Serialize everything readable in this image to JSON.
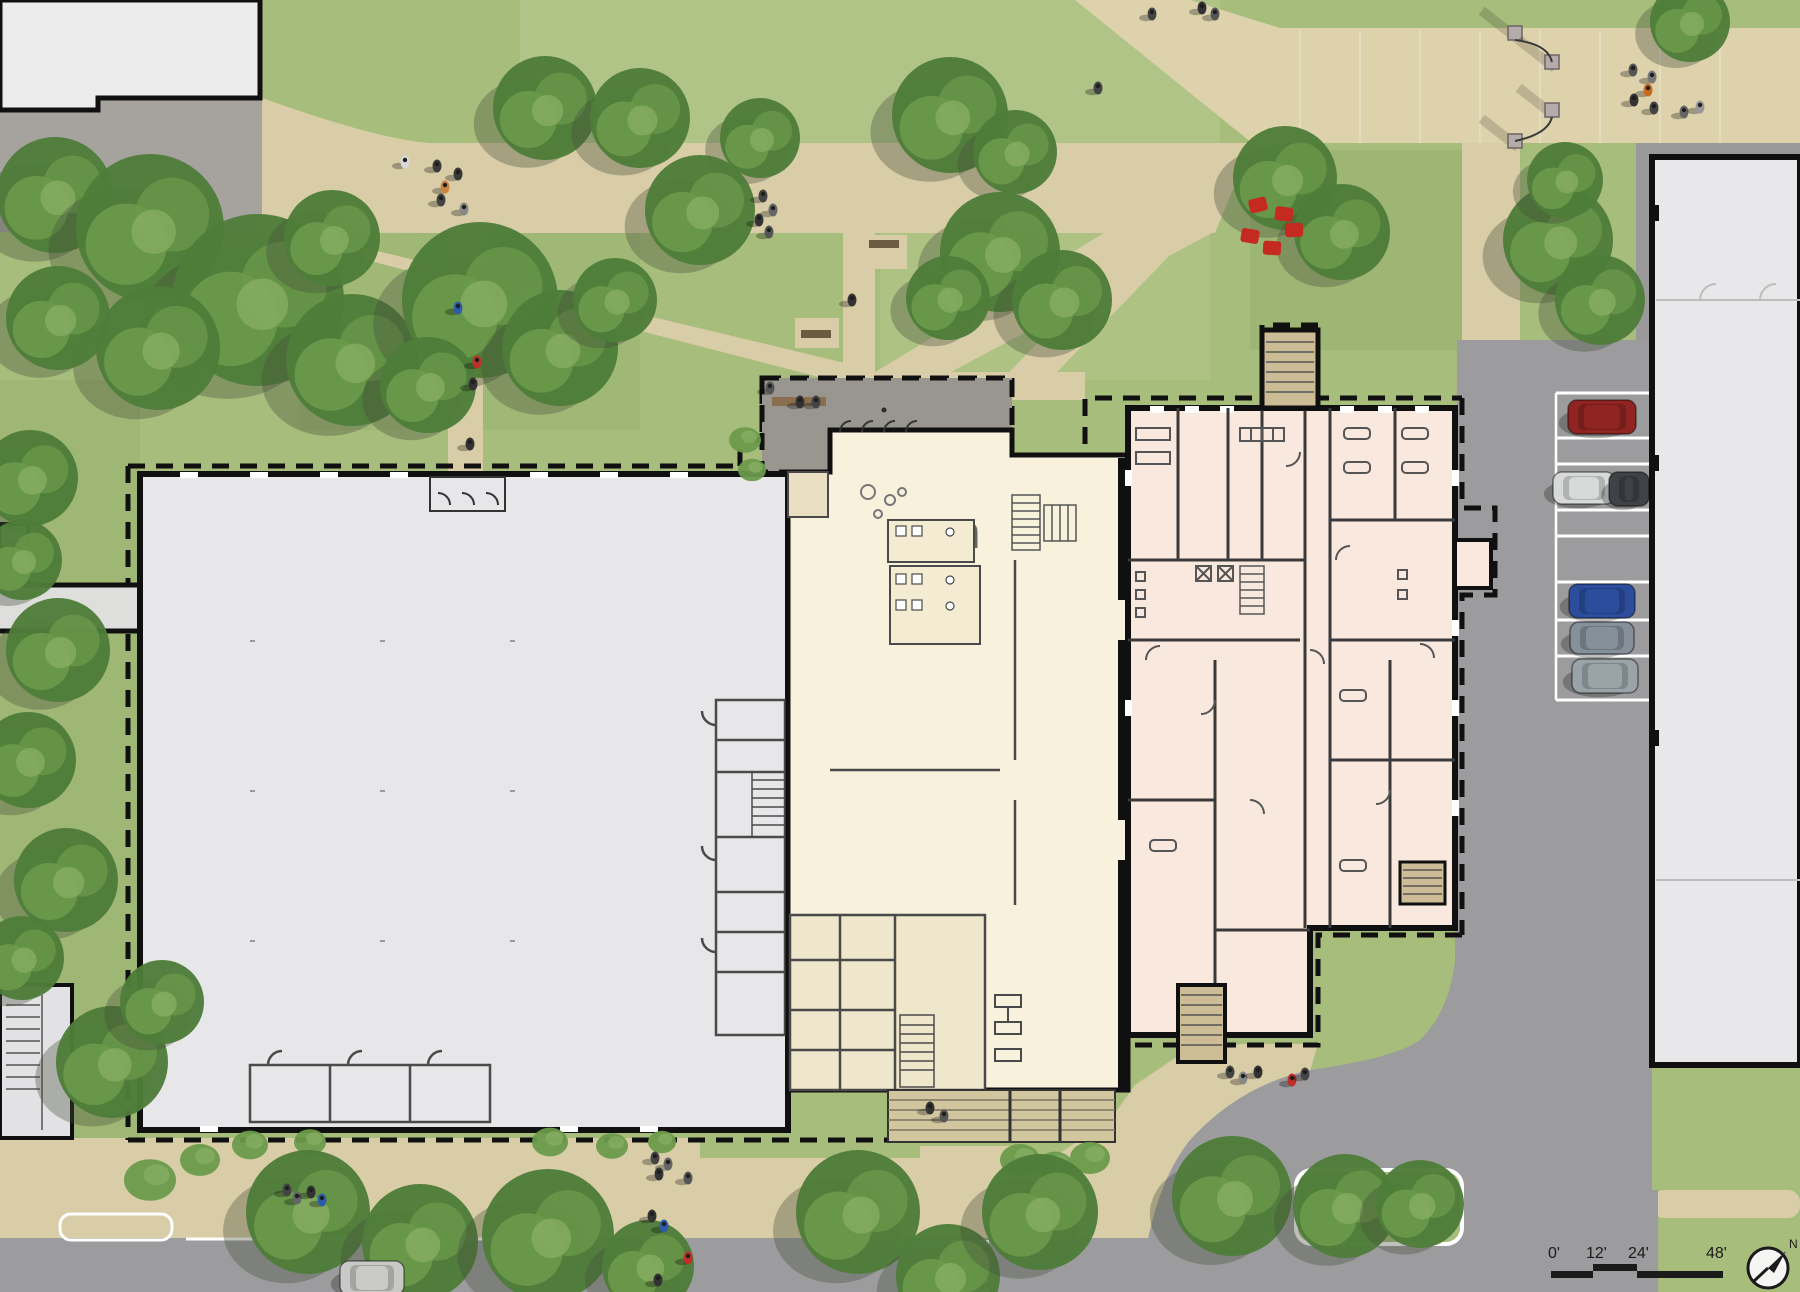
{
  "drawing": {
    "kind": "architectural-site-plan",
    "scalebar": {
      "labels": [
        "0'",
        "12'",
        "24'",
        "48'"
      ],
      "label_pos": [
        [
          1548,
          1258
        ],
        [
          1586,
          1258
        ],
        [
          1628,
          1258
        ],
        [
          1706,
          1258
        ]
      ],
      "segments": [
        {
          "x": 1551,
          "w": 42,
          "dy": 0
        },
        {
          "x": 1593,
          "w": 44,
          "dy": -7
        },
        {
          "x": 1637,
          "w": 86,
          "dy": 0
        }
      ],
      "bar_y": 1271,
      "bar_h": 7
    },
    "north_label": "N"
  },
  "colors": {
    "grass": "#a7bd7c",
    "grass_light": "#b9cb92",
    "grass_dark": "#93ad68",
    "tree_dark": "#4e7d39",
    "tree_mid": "#6b9a4b",
    "tree_light": "#87ae63",
    "shadow": "rgba(70,78,58,0.35)",
    "path": "#d9cda7",
    "path_light": "#e0d6b2",
    "road": "#9c9c9e",
    "road_line": "#ffffff",
    "plaza": "#a6a39e",
    "terrace": "#98968f",
    "bldg_gray": "#e7e7e9",
    "bldg_cream": "#f8f1dc",
    "bldg_cream_dark": "#eadfc2",
    "bldg_pink": "#f9e8de",
    "bldg_pink_dark": "#f3dccd",
    "wall": "#101010",
    "wall_thin": "#4a4a4a",
    "bench": "#8a6f4e",
    "bollard": "#b5abab",
    "blanket": "#c42a20"
  },
  "trees": [
    {
      "x": 55,
      "y": 195,
      "r": 58
    },
    {
      "x": 150,
      "y": 228,
      "r": 74
    },
    {
      "x": 258,
      "y": 300,
      "r": 86
    },
    {
      "x": 352,
      "y": 360,
      "r": 66
    },
    {
      "x": 158,
      "y": 348,
      "r": 62
    },
    {
      "x": 58,
      "y": 318,
      "r": 52
    },
    {
      "x": 332,
      "y": 238,
      "r": 48
    },
    {
      "x": 545,
      "y": 108,
      "r": 52
    },
    {
      "x": 640,
      "y": 118,
      "r": 50
    },
    {
      "x": 760,
      "y": 138,
      "r": 40
    },
    {
      "x": 950,
      "y": 115,
      "r": 58
    },
    {
      "x": 1015,
      "y": 152,
      "r": 42
    },
    {
      "x": 480,
      "y": 300,
      "r": 78
    },
    {
      "x": 560,
      "y": 348,
      "r": 58
    },
    {
      "x": 428,
      "y": 385,
      "r": 48
    },
    {
      "x": 615,
      "y": 300,
      "r": 42
    },
    {
      "x": 700,
      "y": 210,
      "r": 55
    },
    {
      "x": 1000,
      "y": 252,
      "r": 60
    },
    {
      "x": 1062,
      "y": 300,
      "r": 50
    },
    {
      "x": 948,
      "y": 298,
      "r": 42
    },
    {
      "x": 1285,
      "y": 178,
      "r": 52
    },
    {
      "x": 1342,
      "y": 232,
      "r": 48
    },
    {
      "x": 1558,
      "y": 240,
      "r": 55
    },
    {
      "x": 1600,
      "y": 300,
      "r": 45
    },
    {
      "x": 1565,
      "y": 180,
      "r": 38
    },
    {
      "x": 1690,
      "y": 22,
      "r": 40
    },
    {
      "x": 30,
      "y": 478,
      "r": 48
    },
    {
      "x": 22,
      "y": 560,
      "r": 40
    },
    {
      "x": 58,
      "y": 650,
      "r": 52
    },
    {
      "x": 28,
      "y": 760,
      "r": 48
    },
    {
      "x": 66,
      "y": 880,
      "r": 52
    },
    {
      "x": 22,
      "y": 958,
      "r": 42
    },
    {
      "x": 112,
      "y": 1062,
      "r": 56
    },
    {
      "x": 162,
      "y": 1002,
      "r": 42
    },
    {
      "x": 308,
      "y": 1212,
      "r": 62
    },
    {
      "x": 420,
      "y": 1242,
      "r": 58
    },
    {
      "x": 548,
      "y": 1235,
      "r": 66
    },
    {
      "x": 648,
      "y": 1266,
      "r": 46
    },
    {
      "x": 858,
      "y": 1212,
      "r": 62
    },
    {
      "x": 948,
      "y": 1276,
      "r": 52
    },
    {
      "x": 1040,
      "y": 1212,
      "r": 58
    },
    {
      "x": 1232,
      "y": 1196,
      "r": 60
    },
    {
      "x": 1345,
      "y": 1206,
      "r": 52
    },
    {
      "x": 1420,
      "y": 1204,
      "r": 44
    }
  ],
  "bushes": [
    {
      "x": 1020,
      "y": 1160,
      "r": 20
    },
    {
      "x": 1055,
      "y": 1166,
      "r": 18
    },
    {
      "x": 1090,
      "y": 1158,
      "r": 20
    },
    {
      "x": 250,
      "y": 1145,
      "r": 18
    },
    {
      "x": 310,
      "y": 1142,
      "r": 16
    },
    {
      "x": 550,
      "y": 1142,
      "r": 18
    },
    {
      "x": 612,
      "y": 1146,
      "r": 16
    },
    {
      "x": 662,
      "y": 1142,
      "r": 14
    },
    {
      "x": 150,
      "y": 1180,
      "r": 26
    },
    {
      "x": 200,
      "y": 1160,
      "r": 20
    },
    {
      "x": 745,
      "y": 440,
      "r": 16
    },
    {
      "x": 752,
      "y": 470,
      "r": 14
    }
  ],
  "people": [
    {
      "x": 405,
      "y": 162,
      "c": "#d8d8d8"
    },
    {
      "x": 437,
      "y": 166,
      "c": "#3a3a3a"
    },
    {
      "x": 458,
      "y": 174,
      "c": "#3a3a3a"
    },
    {
      "x": 445,
      "y": 187,
      "c": "#c9823f"
    },
    {
      "x": 441,
      "y": 200,
      "c": "#444444"
    },
    {
      "x": 464,
      "y": 209,
      "c": "#888888"
    },
    {
      "x": 458,
      "y": 308,
      "c": "#2a5caa"
    },
    {
      "x": 477,
      "y": 362,
      "c": "#c03028"
    },
    {
      "x": 473,
      "y": 384,
      "c": "#333333"
    },
    {
      "x": 470,
      "y": 444,
      "c": "#333333"
    },
    {
      "x": 763,
      "y": 196,
      "c": "#444444"
    },
    {
      "x": 773,
      "y": 210,
      "c": "#666666"
    },
    {
      "x": 759,
      "y": 220,
      "c": "#333333"
    },
    {
      "x": 769,
      "y": 232,
      "c": "#555555"
    },
    {
      "x": 852,
      "y": 300,
      "c": "#333333"
    },
    {
      "x": 1202,
      "y": 8,
      "c": "#333333"
    },
    {
      "x": 1215,
      "y": 14,
      "c": "#555555"
    },
    {
      "x": 1152,
      "y": 14,
      "c": "#444444"
    },
    {
      "x": 1633,
      "y": 70,
      "c": "#555555"
    },
    {
      "x": 1652,
      "y": 77,
      "c": "#777777"
    },
    {
      "x": 1648,
      "y": 90,
      "c": "#c96a20"
    },
    {
      "x": 1634,
      "y": 100,
      "c": "#333333"
    },
    {
      "x": 1654,
      "y": 108,
      "c": "#444444"
    },
    {
      "x": 1684,
      "y": 112,
      "c": "#666666"
    },
    {
      "x": 1700,
      "y": 107,
      "c": "#999999"
    },
    {
      "x": 1098,
      "y": 88,
      "c": "#444444"
    },
    {
      "x": 287,
      "y": 1190,
      "c": "#444444"
    },
    {
      "x": 297,
      "y": 1198,
      "c": "#666666"
    },
    {
      "x": 311,
      "y": 1192,
      "c": "#333333"
    },
    {
      "x": 322,
      "y": 1200,
      "c": "#2a5caa"
    },
    {
      "x": 655,
      "y": 1158,
      "c": "#444444"
    },
    {
      "x": 668,
      "y": 1164,
      "c": "#666666"
    },
    {
      "x": 659,
      "y": 1174,
      "c": "#333333"
    },
    {
      "x": 688,
      "y": 1178,
      "c": "#555555"
    },
    {
      "x": 652,
      "y": 1216,
      "c": "#333333"
    },
    {
      "x": 664,
      "y": 1226,
      "c": "#2a5caa"
    },
    {
      "x": 688,
      "y": 1258,
      "c": "#c03028"
    },
    {
      "x": 658,
      "y": 1280,
      "c": "#333333"
    },
    {
      "x": 1230,
      "y": 1072,
      "c": "#444444"
    },
    {
      "x": 1243,
      "y": 1078,
      "c": "#888888"
    },
    {
      "x": 1258,
      "y": 1072,
      "c": "#333333"
    },
    {
      "x": 1292,
      "y": 1080,
      "c": "#c03028"
    },
    {
      "x": 1305,
      "y": 1074,
      "c": "#444444"
    },
    {
      "x": 930,
      "y": 1108,
      "c": "#333333"
    },
    {
      "x": 944,
      "y": 1116,
      "c": "#555555"
    },
    {
      "x": 800,
      "y": 402,
      "c": "#333333"
    },
    {
      "x": 816,
      "y": 402,
      "c": "#444444"
    },
    {
      "x": 770,
      "y": 388,
      "c": "#555555"
    }
  ],
  "blankets": [
    {
      "x": 1258,
      "y": 205
    },
    {
      "x": 1284,
      "y": 214
    },
    {
      "x": 1250,
      "y": 236
    },
    {
      "x": 1272,
      "y": 248
    },
    {
      "x": 1294,
      "y": 230
    }
  ],
  "cars": [
    {
      "x": 1602,
      "y": 417,
      "c": "#8f2420",
      "w": 68,
      "h": 34
    },
    {
      "x": 1584,
      "y": 488,
      "c": "#d8dad9",
      "w": 62,
      "h": 32
    },
    {
      "x": 1629,
      "y": 489,
      "c": "#3f4246",
      "w": 40,
      "h": 34
    },
    {
      "x": 1602,
      "y": 601,
      "c": "#2b4d9b",
      "w": 66,
      "h": 34
    },
    {
      "x": 1602,
      "y": 638,
      "c": "#86909a",
      "w": 64,
      "h": 32
    },
    {
      "x": 1605,
      "y": 676,
      "c": "#9aa4a8",
      "w": 66,
      "h": 34
    },
    {
      "x": 372,
      "y": 1278,
      "c": "#c9c9c7",
      "w": 64,
      "h": 34
    }
  ],
  "bollards": [
    {
      "x": 1515,
      "y": 33
    },
    {
      "x": 1552,
      "y": 62
    },
    {
      "x": 1552,
      "y": 110
    },
    {
      "x": 1515,
      "y": 141
    }
  ],
  "parking": {
    "x1": 1556,
    "x2": 1650,
    "lines": [
      393,
      438,
      464,
      510,
      536,
      582,
      620,
      656,
      700
    ]
  },
  "crosswalk": {
    "x": 951,
    "w": 38,
    "h": 7,
    "ys": [
      1240,
      1252,
      1264,
      1276,
      1288
    ]
  }
}
